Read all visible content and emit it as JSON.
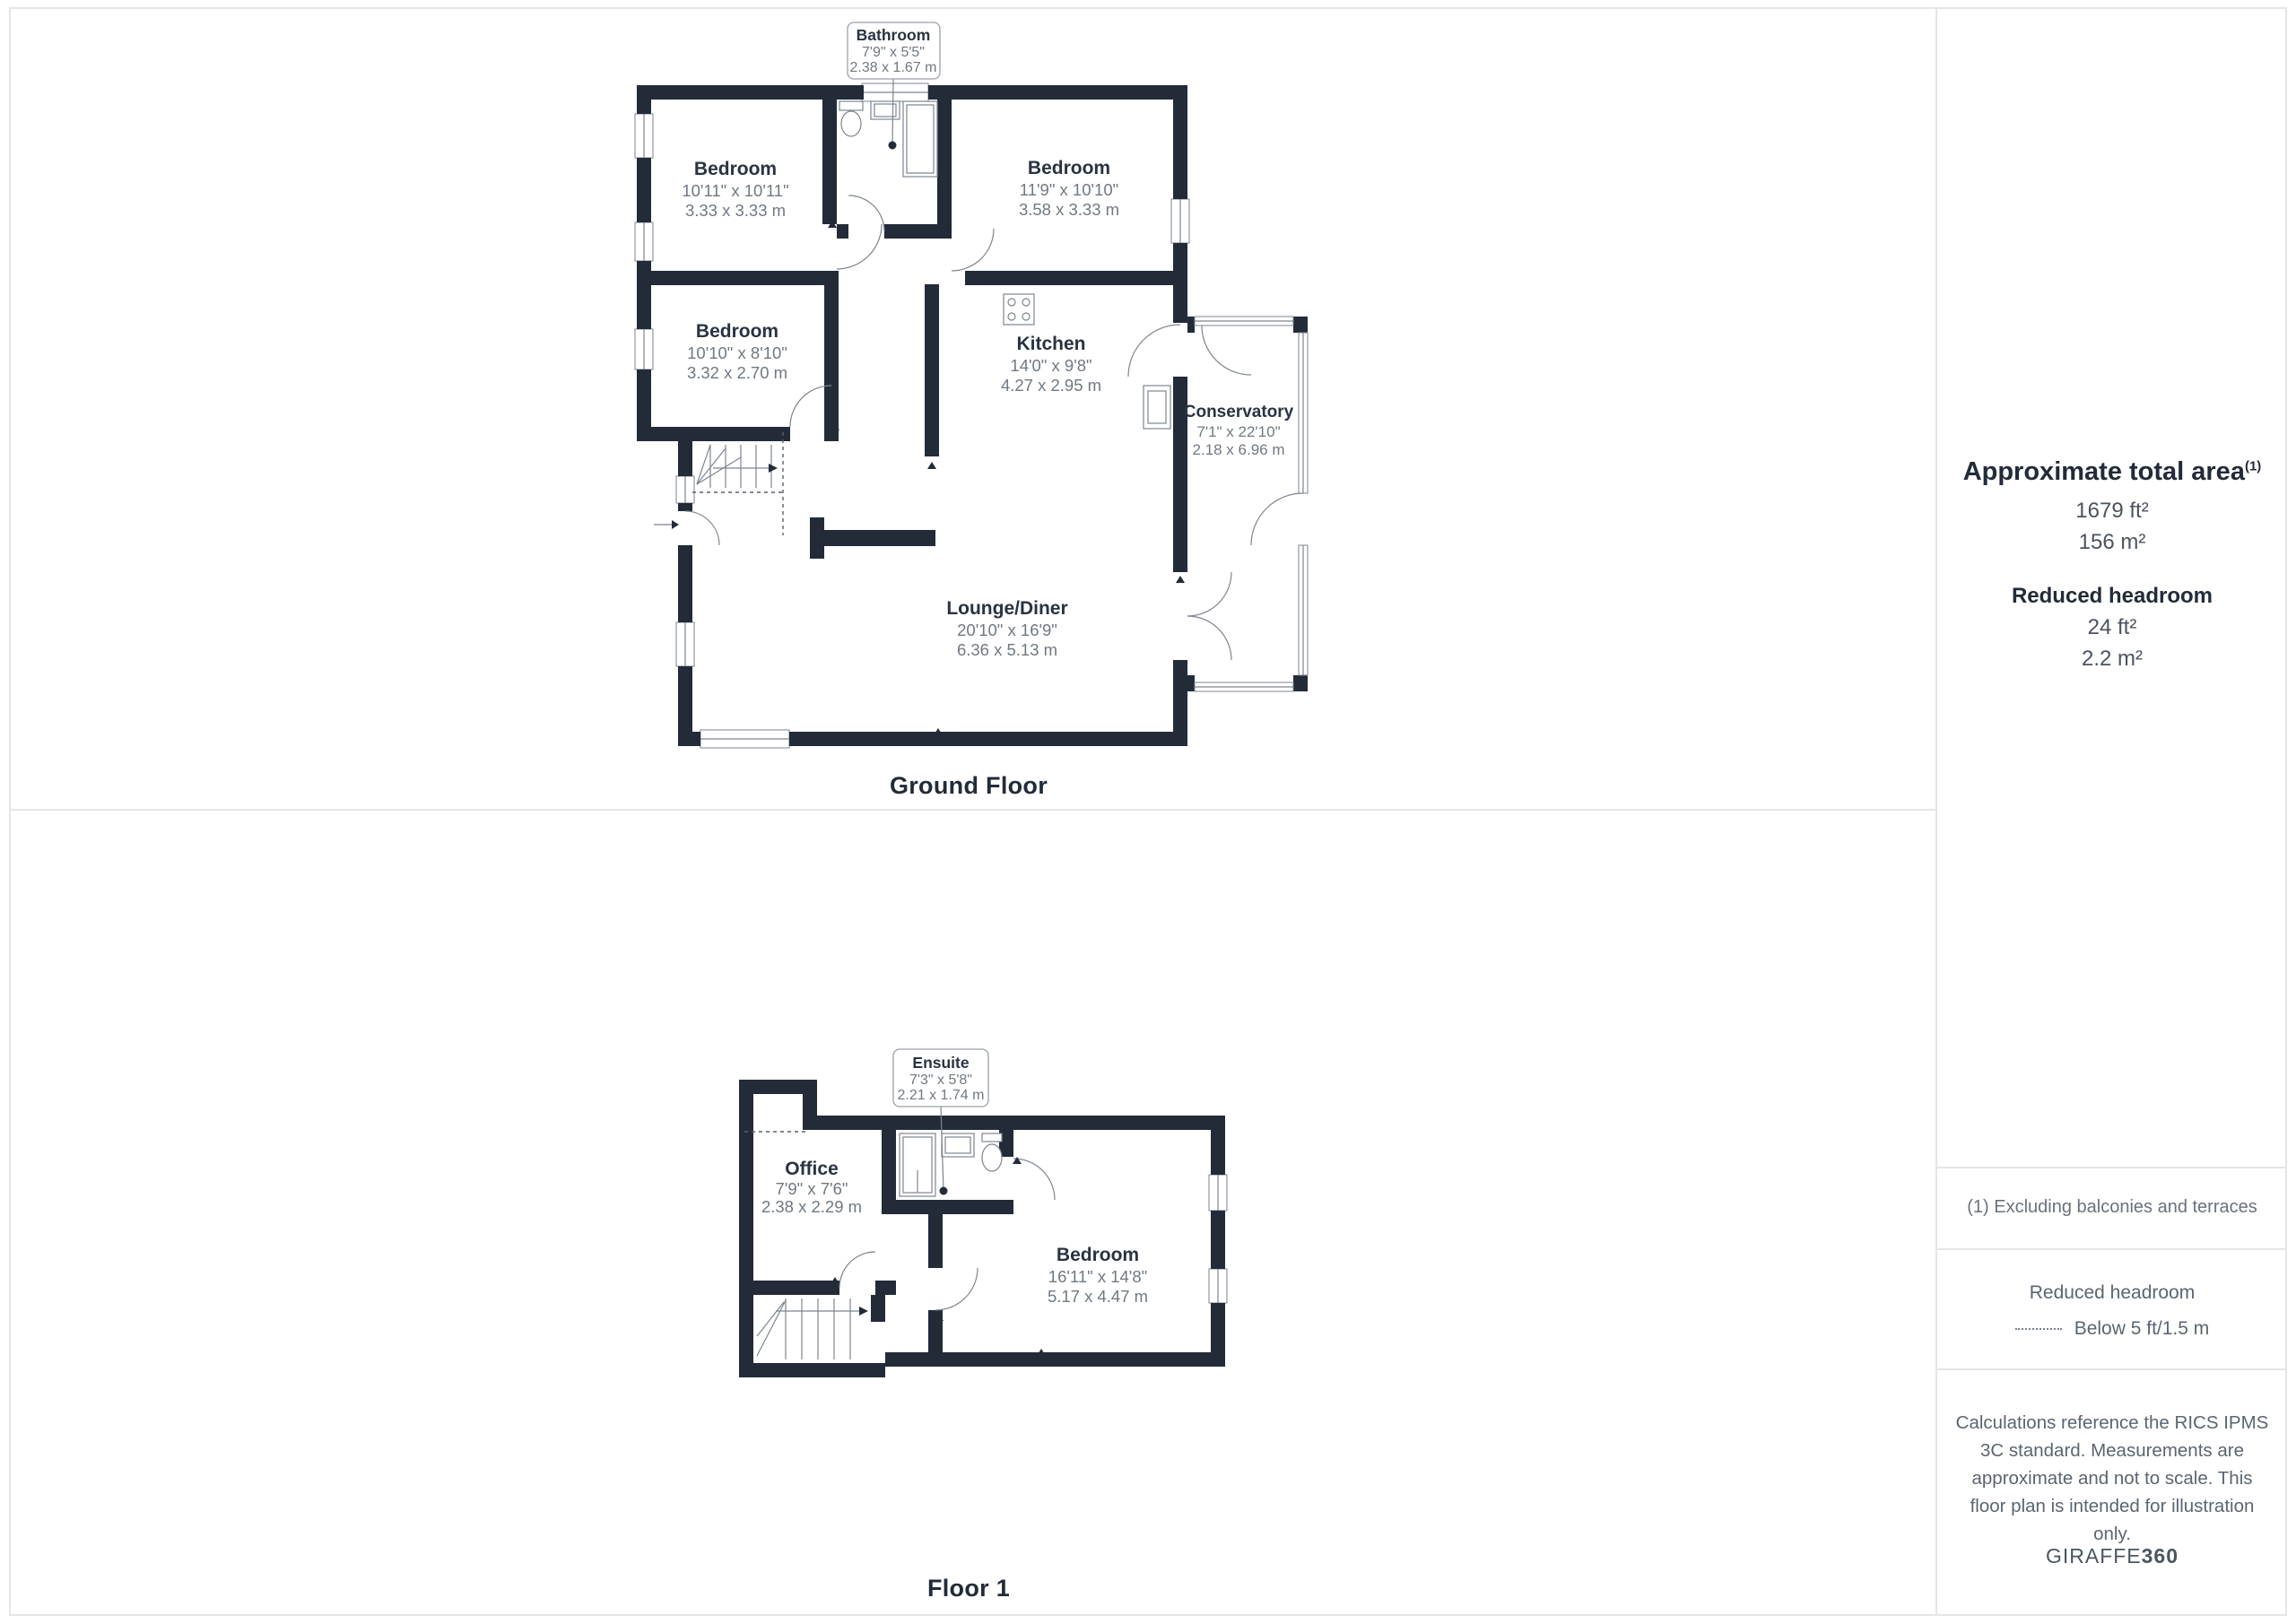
{
  "colors": {
    "wall": "#232b39",
    "room_name_text": "#2a3342",
    "dimension_text": "#6f7983",
    "note_text": "#5b6570",
    "grid_line": "#e4e5e7"
  },
  "ground_floor": {
    "title": "Ground Floor",
    "callout": {
      "name": "Bathroom",
      "imperial": "7'9\" x 5'5\"",
      "metric": "2.38 x 1.67 m"
    },
    "rooms": {
      "bedroom_tl": {
        "name": "Bedroom",
        "imperial": "10'11\" x 10'11\"",
        "metric": "3.33 x 3.33 m"
      },
      "bedroom_tr": {
        "name": "Bedroom",
        "imperial": "11'9\" x 10'10\"",
        "metric": "3.58 x 3.33 m"
      },
      "bedroom_ml": {
        "name": "Bedroom",
        "imperial": "10'10\" x 8'10\"",
        "metric": "3.32 x 2.70 m"
      },
      "kitchen": {
        "name": "Kitchen",
        "imperial": "14'0\" x 9'8\"",
        "metric": "4.27 x 2.95 m"
      },
      "conservatory": {
        "name": "Conservatory",
        "imperial": "7'1\" x 22'10\"",
        "metric": "2.18 x 6.96 m"
      },
      "lounge": {
        "name": "Lounge/Diner",
        "imperial": "20'10\" x 16'9\"",
        "metric": "6.36 x 5.13 m"
      }
    }
  },
  "floor_1": {
    "title": "Floor 1",
    "callout": {
      "name": "Ensuite",
      "imperial": "7'3\" x 5'8\"",
      "metric": "2.21 x 1.74 m"
    },
    "rooms": {
      "office": {
        "name": "Office",
        "imperial": "7'9\" x 7'6\"",
        "metric": "2.38 x 2.29 m"
      },
      "bedroom": {
        "name": "Bedroom",
        "imperial": "16'11\" x 14'8\"",
        "metric": "5.17 x 4.47 m"
      }
    }
  },
  "sidebar": {
    "area_heading": "Approximate total area",
    "area_footnote_marker": "(1)",
    "area_imperial": "1679 ft²",
    "area_metric": "156 m²",
    "headroom_heading": "Reduced headroom",
    "headroom_imperial": "24 ft²",
    "headroom_metric": "2.2 m²",
    "footnote": "(1) Excluding balconies and terraces",
    "legend_heading": "Reduced headroom",
    "legend_item": "Below 5 ft/1.5 m",
    "disclaimer": "Calculations reference the RICS IPMS 3C standard. Measurements are approximate and not to scale. This floor plan is intended for illustration only.",
    "brand_name": "GIRAFFE",
    "brand_suffix": "360"
  }
}
